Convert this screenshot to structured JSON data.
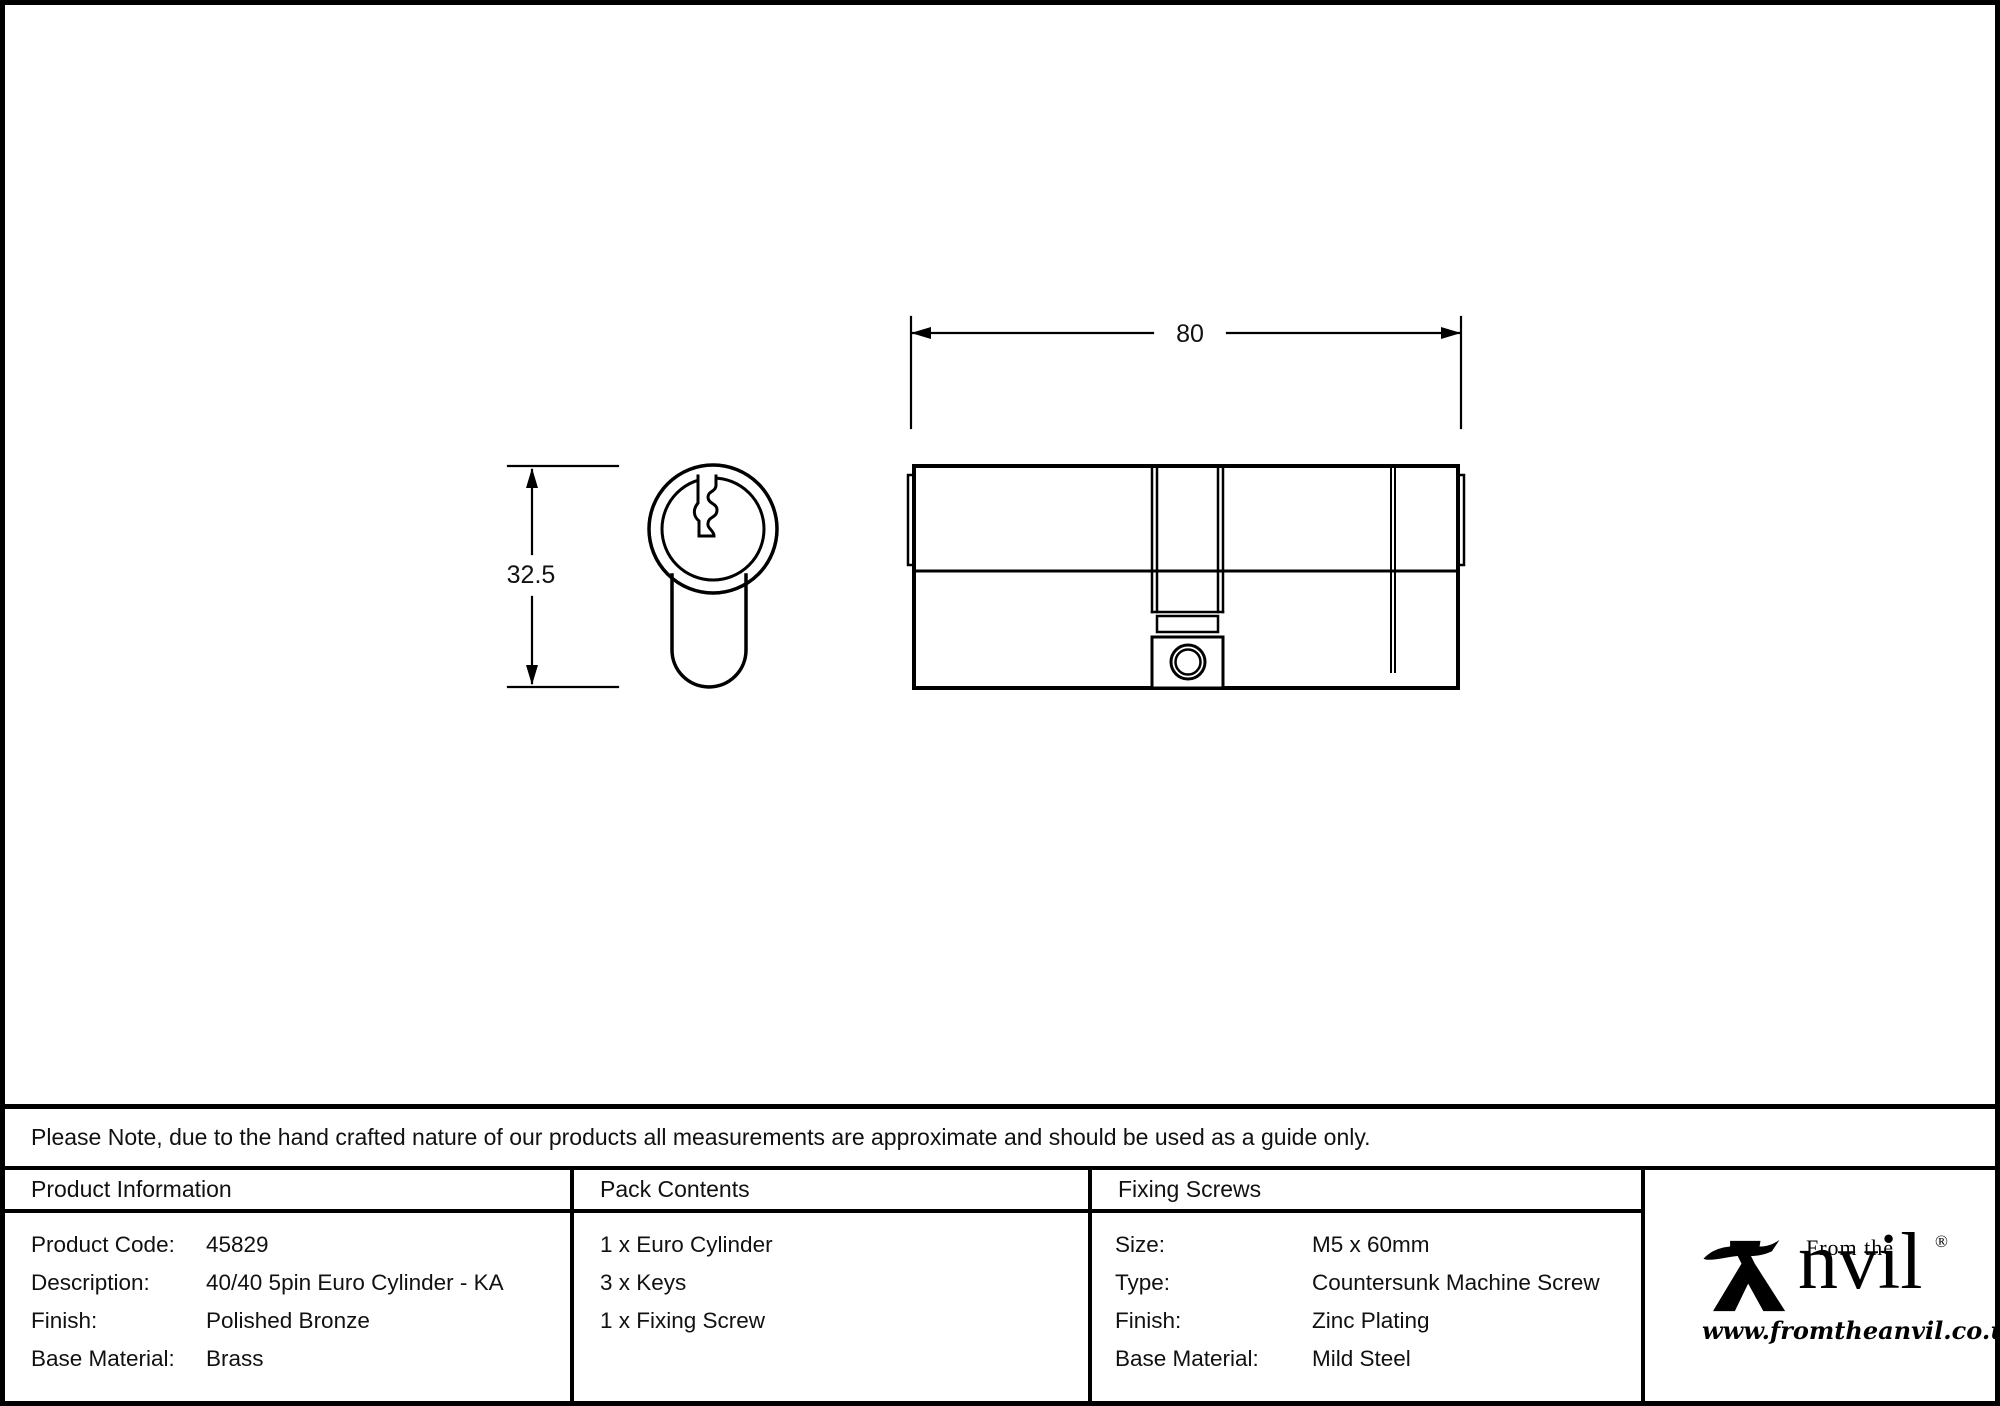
{
  "drawing": {
    "width_dim": "80",
    "height_dim": "32.5"
  },
  "note": "Please Note, due to the hand crafted nature of our products all measurements are approximate and should be used as a guide only.",
  "table": {
    "product_info": {
      "header": "Product Information",
      "rows": [
        {
          "label": "Product Code:",
          "value": "45829"
        },
        {
          "label": "Description:",
          "value": "40/40 5pin Euro Cylinder - KA"
        },
        {
          "label": "Finish:",
          "value": "Polished Bronze"
        },
        {
          "label": "Base Material:",
          "value": "Brass"
        }
      ]
    },
    "pack_contents": {
      "header": "Pack Contents",
      "items": [
        "1 x Euro Cylinder",
        "3 x Keys",
        "1 x Fixing Screw"
      ]
    },
    "fixing_screws": {
      "header": "Fixing Screws",
      "rows": [
        {
          "label": "Size:",
          "value": "M5 x 60mm"
        },
        {
          "label": "Type:",
          "value": "Countersunk Machine Screw"
        },
        {
          "label": "Finish:",
          "value": "Zinc Plating"
        },
        {
          "label": "Base Material:",
          "value": "Mild Steel"
        }
      ]
    }
  },
  "logo": {
    "from_the": "From the",
    "name_suffix": "nvil",
    "registered": "®",
    "url": "www.fromtheanvil.co.uk"
  },
  "colors": {
    "line": "#000000",
    "background": "#ffffff"
  }
}
